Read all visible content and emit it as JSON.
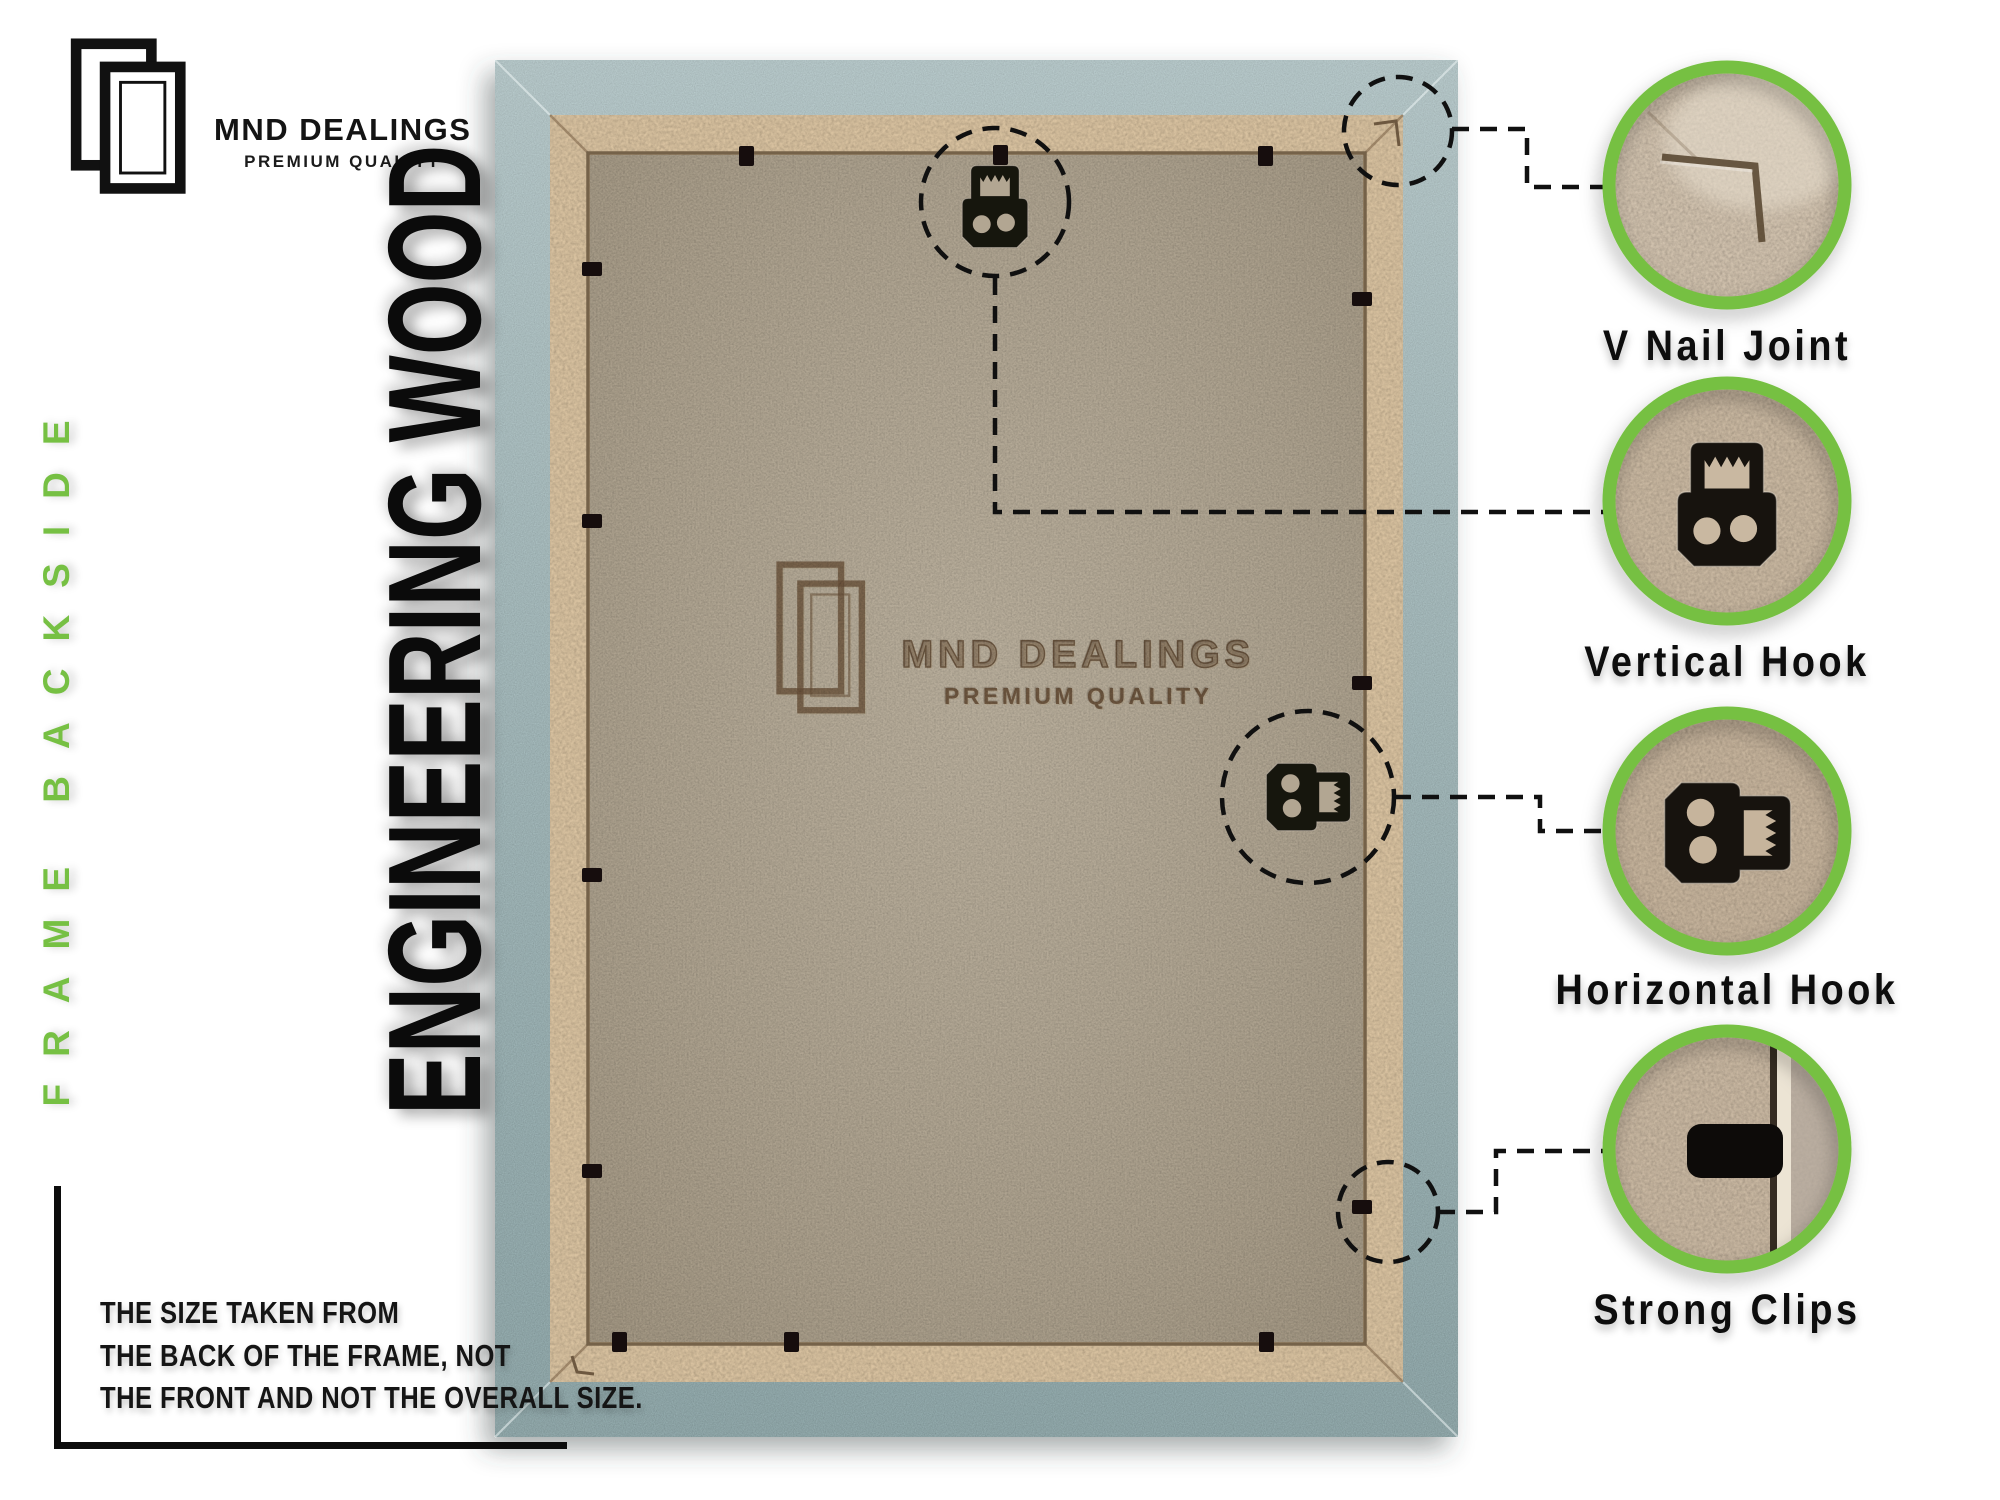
{
  "brand": {
    "name": "MND DEALINGS",
    "tagline": "PREMIUM QUALITY"
  },
  "side_label": "FRAME BACKSIDE",
  "material_label": "ENGINEERING WOOD",
  "watermark": {
    "name": "MND DEALINGS",
    "tagline": "PREMIUM QUALITY"
  },
  "callouts": [
    {
      "label": "V Nail Joint"
    },
    {
      "label": "Vertical Hook"
    },
    {
      "label": "Horizontal Hook"
    },
    {
      "label": "Strong Clips"
    }
  ],
  "note_lines": [
    "THE SIZE TAKEN FROM",
    "THE BACK OF THE FRAME, NOT",
    "THE FRONT AND NOT THE OVERALL SIZE."
  ],
  "icons": {
    "brand_logo": "double-picture-frame-icon",
    "watermark_logo": "double-picture-frame-icon"
  },
  "colors": {
    "accent_green": "#76c043",
    "ink": "#101010",
    "frame_outer": "#a6bdbf",
    "frame_border_wood": "#d9c2a0",
    "mdf_panel": "#b3a793",
    "hardware_black": "#16120e"
  }
}
